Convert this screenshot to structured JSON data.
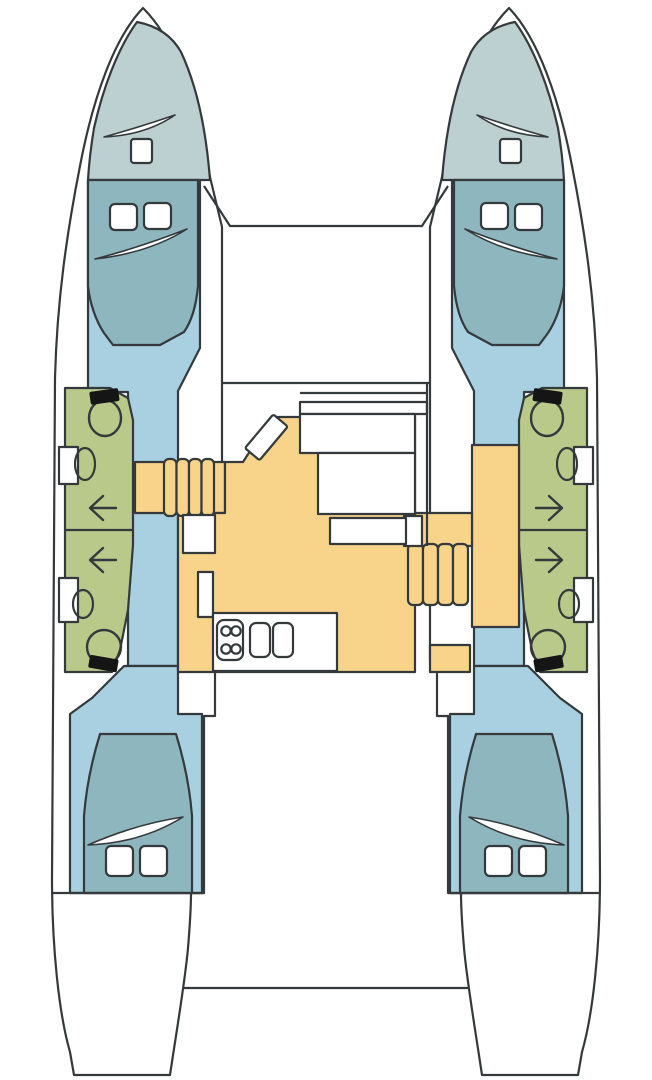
{
  "diagram": {
    "type": "catamaran-deck-plan",
    "view": "top-down layout plan, no visible text labels",
    "colors": {
      "background": "#ffffff",
      "outline": "#343a3c",
      "hull": "#ffffff",
      "forepeak": "#bccfd1",
      "berth": "#8eb6be",
      "cabin_floor": "#a9d0e0",
      "bathroom": "#b9c98a",
      "saloon_floor": "#f8d48b",
      "fixture_white": "#ffffff",
      "fixture_black": "#151515"
    },
    "features": {
      "port_hull": [
        "forepeak locker with deck hatch",
        "forward double berth with two pillows and turned-down sheet",
        "head compartment with toilet, washbasin and storage insets",
        "two access arrows pointing outboard",
        "second washbasin and toilet aft",
        "aft double berth with two pillows and turned-down sheet"
      ],
      "starboard_hull": [
        "forepeak locker with deck hatch",
        "forward double berth with two pillows and turned-down sheet",
        "head compartment with toilet, washbasin and storage insets",
        "two access arrows pointing outboard",
        "second washbasin and toilet aft",
        "aft double berth with two pillows and turned-down sheet"
      ],
      "nacelle": [
        "forward crossbeam and trampoline area",
        "saloon with forward-facing seat band",
        "rotated nav/chart seat",
        "dining table with bench seating",
        "galley counter with four-burner stove and double sink",
        "port companionway of four steps",
        "starboard companionway of four steps with landing",
        "aft cockpit bench line between sterns"
      ],
      "counts": {
        "hulls": 2,
        "cabins": 4,
        "toilets": 4,
        "washbasins": 4,
        "steps_per_companionway": 4,
        "stove_burners": 4,
        "sink_bowls": 2
      }
    }
  }
}
